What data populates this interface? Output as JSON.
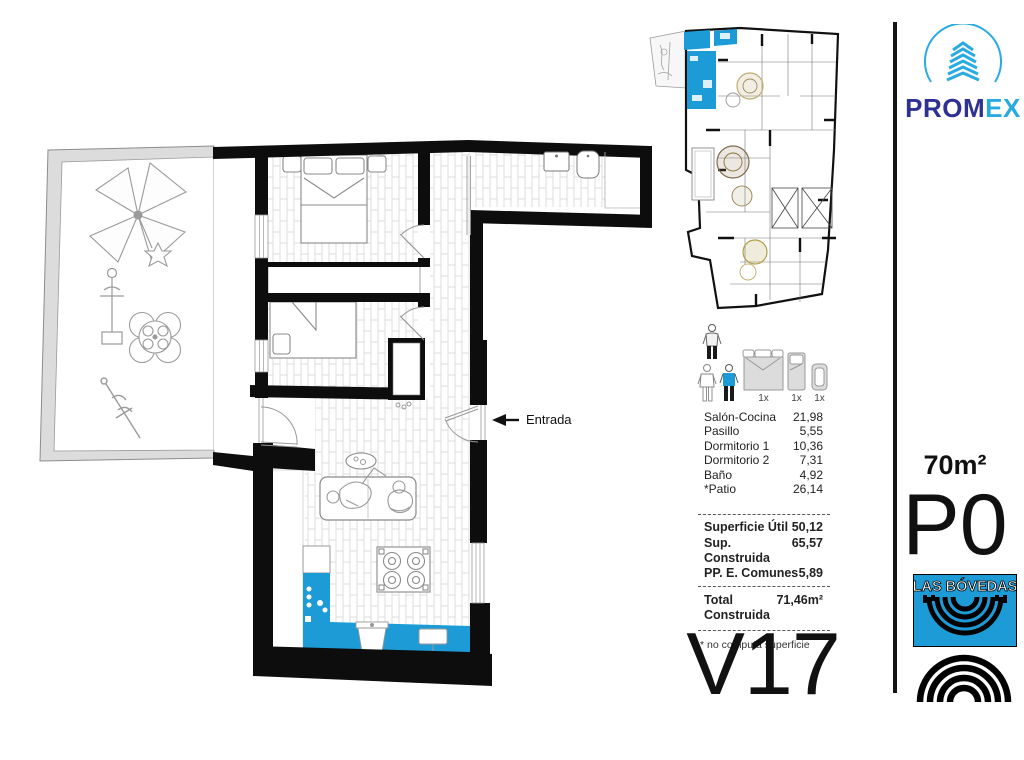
{
  "plan": {
    "entrance_label": "Entrada",
    "unit_code": "V17"
  },
  "unit": {
    "area": "70m²",
    "floor": "P0"
  },
  "brand": {
    "promex_primary": "PROM",
    "promex_accent": "EX",
    "las_bovedas": "LAS BÓVEDAS"
  },
  "legend": {
    "items": [
      {
        "name": "double-bed",
        "count": "1x"
      },
      {
        "name": "single-bed",
        "count": "1x"
      },
      {
        "name": "crib",
        "count": "1x"
      }
    ]
  },
  "areas": {
    "rooms": [
      {
        "label": "Salón-Cocina",
        "value": "21,98"
      },
      {
        "label": "Pasillo",
        "value": "5,55"
      },
      {
        "label": "Dormitorio 1",
        "value": "10,36"
      },
      {
        "label": "Dormitorio 2",
        "value": "7,31"
      },
      {
        "label": "Baño",
        "value": "4,92"
      },
      {
        "label": "*Patio",
        "value": "26,14"
      }
    ],
    "summary": [
      {
        "label": "Superficie Útil",
        "value": "50,12"
      },
      {
        "label": "Sup. Construida",
        "value": "65,57"
      },
      {
        "label": "PP. E. Comunes",
        "value": "5,89"
      }
    ],
    "total": {
      "label": "Total Construida",
      "value": "71,46m²"
    },
    "footnote": "* no computa superficie"
  },
  "colors": {
    "accent": "#1d9bd7",
    "promex_navy": "#2e3192",
    "promex_blue": "#29abe2"
  }
}
